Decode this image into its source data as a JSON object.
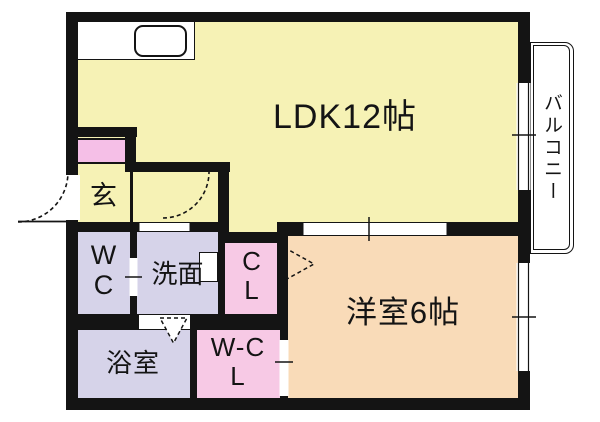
{
  "plan_title": "1LDK apartment floor plan",
  "rooms": {
    "ldk": {
      "label": "LDK12帖",
      "color": "#f6f2b5"
    },
    "western": {
      "label": "洋室6帖",
      "color": "#f9dbb8"
    },
    "entrance": {
      "label": "玄",
      "color": "#f6f2b5"
    },
    "wc": {
      "label": "WC",
      "color": "#d6d3e9"
    },
    "washroom": {
      "label": "洗面",
      "color": "#d6d3e9"
    },
    "bathroom": {
      "label": "浴室",
      "color": "#d6d3e9"
    },
    "closet": {
      "label": "CL",
      "color": "#f7c9e5"
    },
    "walkin_closet": {
      "label": "W-CL",
      "color": "#f7c9e5"
    },
    "balcony": {
      "label": "バルコニー",
      "color": "#ffffff"
    }
  },
  "colors": {
    "wall": "#141414",
    "background": "#ffffff",
    "shoe_cabinet": "#f5bfe7"
  }
}
